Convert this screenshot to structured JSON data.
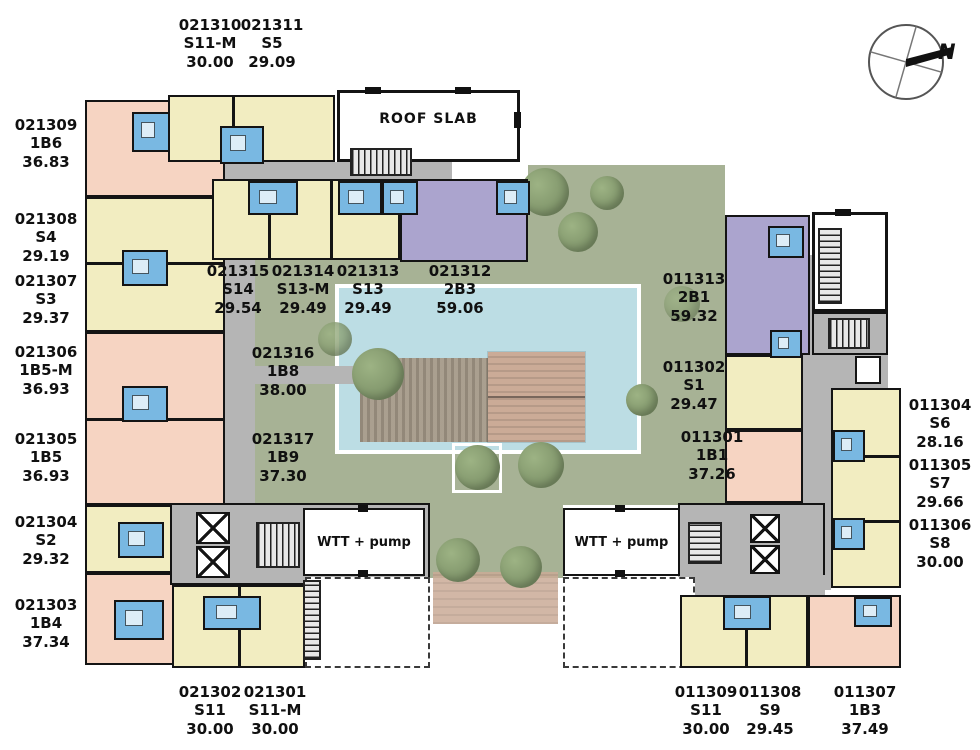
{
  "annotations": {
    "roof_slab": "ROOF SLAB",
    "wtt_pump": "WTT + pump",
    "north": "N"
  },
  "colors": {
    "studio": "#f2edc1",
    "one_bedroom": "#f6d4c2",
    "two_bedroom": "#aba4ce",
    "pool": "#bcdde4",
    "landscape": "#a7b295",
    "corridor": "#b5b5b5",
    "deck": "#cbab97",
    "bathroom": "#79b8e2"
  },
  "units": [
    {
      "id": "021310",
      "type": "S11-M",
      "area": "30.00",
      "label_x": 210,
      "label_y": 16
    },
    {
      "id": "021311",
      "type": "S5",
      "area": "29.09",
      "label_x": 272,
      "label_y": 16
    },
    {
      "id": "021309",
      "type": "1B6",
      "area": "36.83",
      "label_x": 46,
      "label_y": 116
    },
    {
      "id": "021308",
      "type": "S4",
      "area": "29.19",
      "label_x": 46,
      "label_y": 210
    },
    {
      "id": "021307",
      "type": "S3",
      "area": "29.37",
      "label_x": 46,
      "label_y": 272
    },
    {
      "id": "021306",
      "type": "1B5-M",
      "area": "36.93",
      "label_x": 46,
      "label_y": 343
    },
    {
      "id": "021305",
      "type": "1B5",
      "area": "36.93",
      "label_x": 46,
      "label_y": 430
    },
    {
      "id": "021304",
      "type": "S2",
      "area": "29.32",
      "label_x": 46,
      "label_y": 513
    },
    {
      "id": "021303",
      "type": "1B4",
      "area": "37.34",
      "label_x": 46,
      "label_y": 596
    },
    {
      "id": "021315",
      "type": "S14",
      "area": "29.54",
      "label_x": 238,
      "label_y": 262
    },
    {
      "id": "021314",
      "type": "S13-M",
      "area": "29.49",
      "label_x": 303,
      "label_y": 262
    },
    {
      "id": "021313",
      "type": "S13",
      "area": "29.49",
      "label_x": 368,
      "label_y": 262
    },
    {
      "id": "021312",
      "type": "2B3",
      "area": "59.06",
      "label_x": 460,
      "label_y": 262
    },
    {
      "id": "021316",
      "type": "1B8",
      "area": "38.00",
      "label_x": 283,
      "label_y": 344
    },
    {
      "id": "021317",
      "type": "1B9",
      "area": "37.30",
      "label_x": 283,
      "label_y": 430
    },
    {
      "id": "011313",
      "type": "2B1",
      "area": "59.32",
      "label_x": 694,
      "label_y": 270
    },
    {
      "id": "011302",
      "type": "S1",
      "area": "29.47",
      "label_x": 694,
      "label_y": 358
    },
    {
      "id": "011301",
      "type": "1B1",
      "area": "37.26",
      "label_x": 712,
      "label_y": 428
    },
    {
      "id": "011304",
      "type": "S6",
      "area": "28.16",
      "label_x": 940,
      "label_y": 396
    },
    {
      "id": "011305",
      "type": "S7",
      "area": "29.66",
      "label_x": 940,
      "label_y": 456
    },
    {
      "id": "011306",
      "type": "S8",
      "area": "30.00",
      "label_x": 940,
      "label_y": 516
    },
    {
      "id": "021302",
      "type": "S11",
      "area": "30.00",
      "label_x": 210,
      "label_y": 683
    },
    {
      "id": "021301",
      "type": "S11-M",
      "area": "30.00",
      "label_x": 275,
      "label_y": 683
    },
    {
      "id": "011309",
      "type": "S11",
      "area": "30.00",
      "label_x": 706,
      "label_y": 683
    },
    {
      "id": "011308",
      "type": "S9",
      "area": "29.45",
      "label_x": 770,
      "label_y": 683
    },
    {
      "id": "011307",
      "type": "1B3",
      "area": "37.49",
      "label_x": 865,
      "label_y": 683
    }
  ]
}
